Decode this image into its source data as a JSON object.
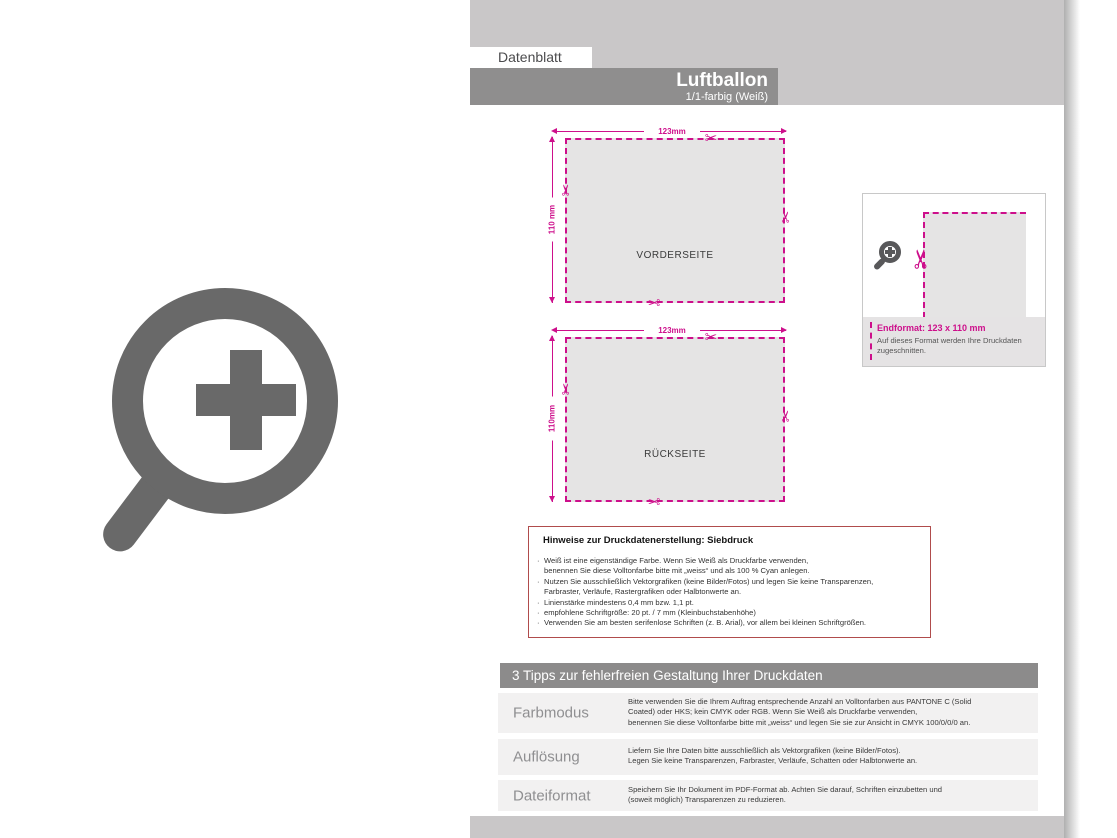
{
  "header": {
    "tab_label": "Datenblatt",
    "title": "Luftballon",
    "subtitle": "1/1-farbig (Weiß)"
  },
  "icons": {
    "scissors": "✂",
    "bullet": "·",
    "zoom_icon": "magnifier-plus"
  },
  "diagrams": {
    "front": {
      "label": "VORDERSEITE",
      "width_label": "123mm",
      "height_label": "110 mm"
    },
    "back": {
      "label": "RÜCKSEITE",
      "width_label": "123mm",
      "height_label": "110mm"
    }
  },
  "endformat": {
    "title": "Endformat: 123 x 110 mm",
    "body": "Auf dieses Format werden Ihre Druckdaten\nzugeschnitten."
  },
  "hinweise": {
    "title": "Hinweise zur Druckdatenerstellung: Siebdruck",
    "bullets": [
      "Weiß ist eine eigenständige Farbe. Wenn Sie Weiß als Druckfarbe verwenden,\nbenennen Sie diese Volltonfarbe bitte mit „weiss“ und als 100 % Cyan anlegen.",
      "Nutzen Sie ausschließlich Vektorgrafiken (keine Bilder/Fotos) und legen Sie keine Transparenzen,\nFarbraster, Verläufe, Rastergrafiken oder Halbtonwerte an.",
      "Linienstärke mindestens 0,4 mm bzw. 1,1 pt.",
      "empfohlene Schriftgröße: 20 pt. / 7 mm (Kleinbuchstabenhöhe)",
      "Verwenden Sie am besten serifenlose Schriften (z. B. Arial), vor allem bei kleinen Schriftgrößen."
    ]
  },
  "tipps": {
    "title": "3 Tipps zur fehlerfreien Gestaltung Ihrer Druckdaten",
    "rows": [
      {
        "label": "Farbmodus",
        "text": "Bitte verwenden Sie die Ihrem Auftrag entsprechende Anzahl an Volltonfarben aus PANTONE C (Solid\nCoated) oder HKS; kein CMYK oder RGB. Wenn Sie Weiß als Druckfarbe verwenden,\nbenennen Sie diese Volltonfarbe bitte mit „weiss“ und legen Sie sie zur Ansicht in CMYK 100/0/0/0 an."
      },
      {
        "label": "Auflösung",
        "text": "Liefern Sie Ihre Daten bitte ausschließlich als Vektorgrafiken (keine Bilder/Fotos).\nLegen Sie keine Transparenzen, Farbraster, Verläufe, Schatten oder Halbtonwerte an."
      },
      {
        "label": "Dateiformat",
        "text": "Speichern Sie Ihr Dokument im PDF-Format ab. Achten Sie darauf, Schriften einzubetten und\n(soweit möglich) Transparenzen zu reduzieren."
      }
    ]
  },
  "colors": {
    "magenta": "#cd0f8b",
    "note_border_red": "#b04c4c",
    "band_gray": "#c9c7c8",
    "title_bar_gray": "#8f8e8e",
    "tipps_bar_gray": "#8c8b8b",
    "row_bg": "#f2f1f1",
    "cut_area_fill": "#e5e4e4",
    "zoom_icon_gray": "#696969"
  }
}
